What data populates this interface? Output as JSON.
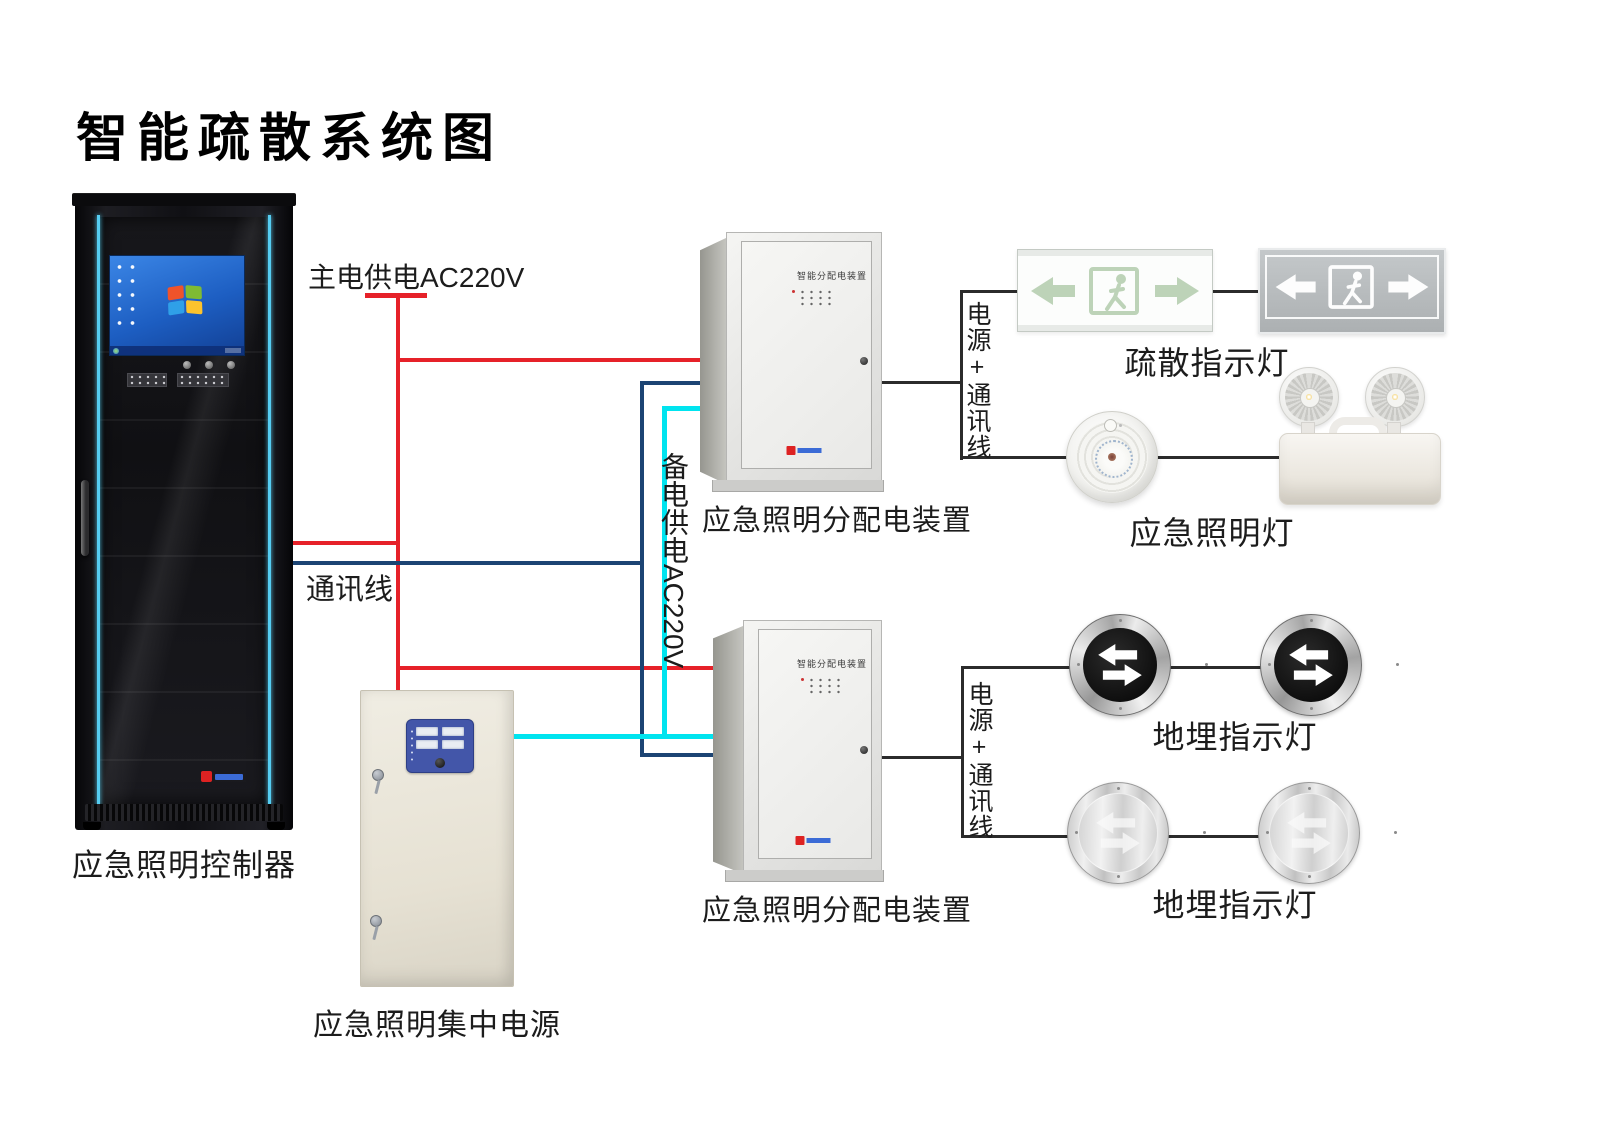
{
  "title": "智能疏散系统图",
  "labels": {
    "controller": "应急照明控制器",
    "central_power": "应急照明集中电源",
    "dist_box_1": "应急照明分配电装置",
    "dist_box_2": "应急照明分配电装置",
    "exit_sign": "疏散指示灯",
    "emergency_light": "应急照明灯",
    "ground_light_1": "地埋指示灯",
    "ground_light_2": "地埋指示灯"
  },
  "wire_labels": {
    "main_power": "主电供电AC220V",
    "comm": "通讯线",
    "backup_power": "备电供电AC220V",
    "power_comm_1": "电源+通讯线",
    "power_comm_2": "电源+通讯线"
  },
  "device_texts": {
    "dist_panel_1": "智能分配电装置",
    "dist_panel_2": "智能分配电装置"
  },
  "wire_colors": {
    "main_power": "#e62129",
    "comm": "#1c4473",
    "backup_power": "#00e4ef",
    "signal": "#2b2b2b"
  }
}
